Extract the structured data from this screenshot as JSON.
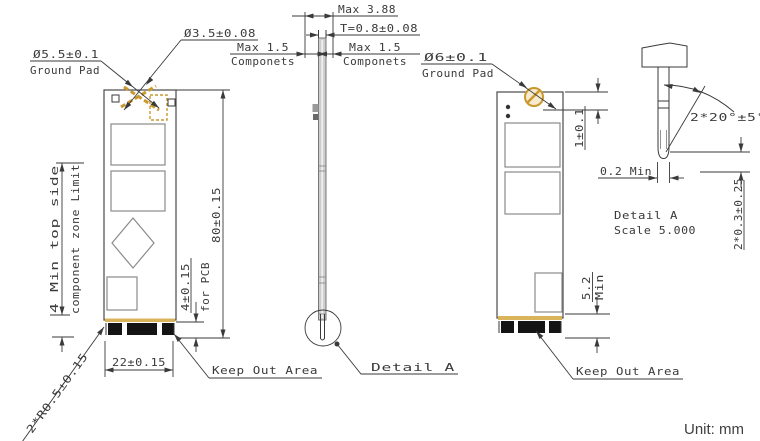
{
  "labels": {
    "dia_5_5": "Ø5.5±0.1",
    "ground_pad_left": "Ground Pad",
    "dia_3_5": "Ø3.5±0.08",
    "max_3_88": "Max 3.88",
    "thickness": "T=0.8±0.08",
    "max_1_5_left": "Max 1.5",
    "componets_left": "Componets",
    "max_1_5_right": "Max 1.5",
    "componets_right": "Componets",
    "dia_6": "Ø6±0.1",
    "ground_pad_right": "Ground Pad",
    "pin_angle": "2*20°±5°",
    "tip_min": "0.2 Min",
    "detail_name": "Detail A",
    "detail_scale": "Scale 5.000",
    "tip_offset": "2*0.3±0.25",
    "pad_offset": "1±0.1",
    "board_length": "80±0.15",
    "edge_finger": "4±0.15",
    "for_pcb": "for PCB",
    "zone_limit_1": "4 Min top side",
    "zone_limit_2": "component zone Limit",
    "board_width": "22±0.15",
    "keep_out_left": "Keep Out Area",
    "keep_out_right": "Keep Out Area",
    "detail_leader": "Detail A",
    "keepout_height": "5.2",
    "keepout_min": "Min",
    "corner_radius": "2*R0.5±0.15",
    "unit": "Unit: mm"
  },
  "colors": {
    "line": "#3a3a3a",
    "gold": "#c9992e",
    "pad": "#141414",
    "strip": "#cdcdcd",
    "chip_stroke": "#8a8a8a"
  }
}
